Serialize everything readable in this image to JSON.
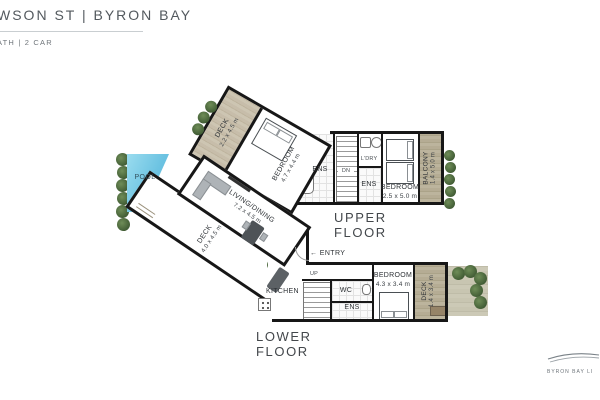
{
  "header": {
    "title": "WSON ST | BYRON BAY",
    "subtitle": "ATH | 2 CAR"
  },
  "branding": {
    "logo_text": "BYRON BAY LI",
    "logo_icon": "wave-lines-icon"
  },
  "upper_floor": {
    "label": "UPPER FLOOR",
    "deck": {
      "name": "DECK",
      "dims": "2.2 x 4.5 m"
    },
    "bedroom1": {
      "name": "BEDROOM",
      "dims": "4.7 x 4.4 m"
    },
    "ens1": {
      "name": "ENS"
    },
    "stairs_label": "DN",
    "laundry": {
      "name": "L'DRY"
    },
    "ens2": {
      "name": "ENS"
    },
    "bedroom2": {
      "name": "BEDROOM",
      "dims": "2.5 x 5.0 m"
    },
    "balcony": {
      "name": "BALCONY",
      "dims": "1.4 x 5.0 m"
    }
  },
  "lower_floor": {
    "label": "LOWER FLOOR",
    "pool_label": "POOL",
    "deck": {
      "name": "DECK",
      "dims": "4.0 x 4.5 m"
    },
    "living": {
      "name": "LIVING/DINING",
      "dims": "7.2 x 4.5 m"
    },
    "kitchen_label": "KITCHEN",
    "entry_arrow": "←",
    "entry_label": "ENTRY",
    "stairs_label": "UP",
    "wc_label": "WC",
    "ens_label": "ENS",
    "bedroom": {
      "name": "BEDROOM",
      "dims": "4.3 x 3.4 m"
    },
    "deck2": {
      "name": "DECK",
      "dims": "1.4 x 3.4 m"
    }
  },
  "colors": {
    "wall": "#171717",
    "pool": "#6cc3e2",
    "wood": "#c7bdaa",
    "plant": "#4b6a3c"
  }
}
